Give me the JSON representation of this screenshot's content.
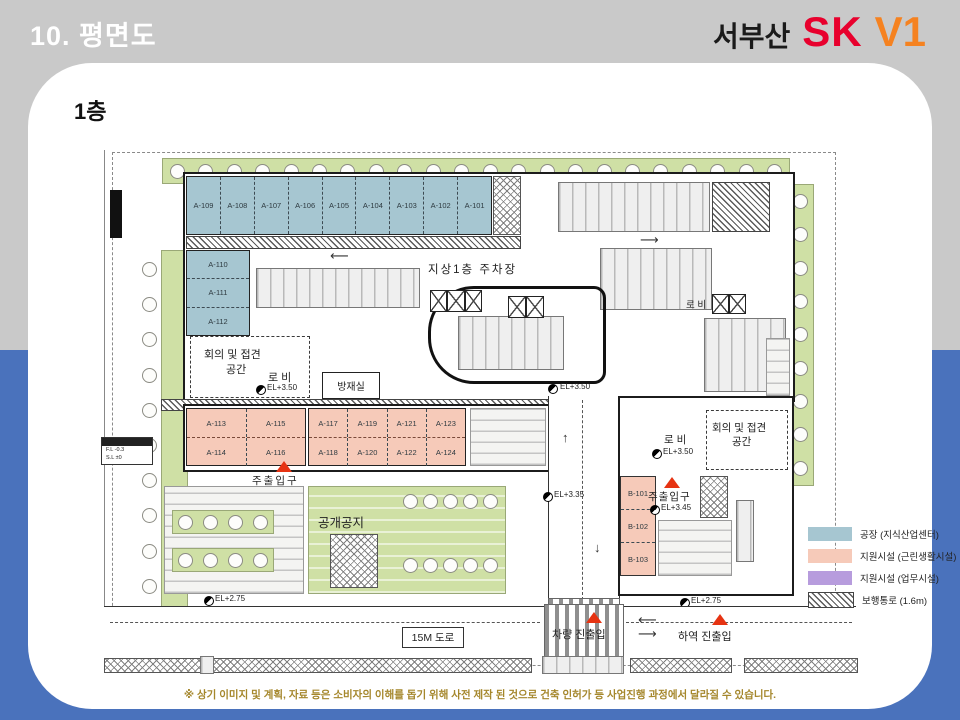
{
  "slide": {
    "title": "10. 평면도",
    "brand": {
      "region": "서부산",
      "sk": "SK",
      "v1": "V1"
    },
    "floor_label": "1층",
    "disclaimer": "※ 상기 이미지 및 계획, 자료 등은 소비자의 이해를 돕기 위해 사전 제작 된 것으로 건축 인허가 등 사업진행 과정에서 달라질 수 있습니다."
  },
  "colors": {
    "header_bg": "#c9c9c9",
    "footer_bg": "#4a72bc",
    "factory": "#a6c6d1",
    "support_retail": "#f6cab9",
    "support_office": "#b79cdd",
    "landscape": "#cfe0a5",
    "entrance_marker": "#e63312"
  },
  "legend": {
    "items": [
      {
        "label": "공장 (지식산업센터)",
        "swatch": "factory"
      },
      {
        "label": "지원시설 (근린생활시설)",
        "swatch": "retail"
      },
      {
        "label": "지원시설 (업무시설)",
        "swatch": "office"
      },
      {
        "label": "보행통로 (1.6m)",
        "swatch": "hatch"
      }
    ]
  },
  "plan": {
    "top_units": [
      "A-109",
      "A-108",
      "A-107",
      "A-106",
      "A-105",
      "A-104",
      "A-103",
      "A-102",
      "A-101"
    ],
    "left_units": [
      "A-110",
      "A-111",
      "A-112"
    ],
    "block_a_top": [
      "A-113",
      "A-115"
    ],
    "block_a_bottom": [
      "A-114",
      "A-116"
    ],
    "block_b_top": [
      "A-117",
      "A-119",
      "A-121",
      "A-123"
    ],
    "block_b_bottom": [
      "A-118",
      "A-120",
      "A-122",
      "A-124"
    ],
    "b_units": [
      "B-101",
      "B-102",
      "B-103"
    ],
    "labels": {
      "parking": "지상1층 주차장",
      "meeting_line1": "회의 및 접견",
      "meeting_line2": "공간",
      "lobby": "로 비",
      "disaster_room": "방재실",
      "public_open_space": "공개공지",
      "main_entrance": "주출입구",
      "road_15m": "15M 도로",
      "vehicle_access": "차량 진출입",
      "loading_access": "하역 진출입",
      "el_350": "EL+3.50",
      "el_345": "EL+3.45",
      "el_335": "EL+3.35",
      "el_325": "EL+3.25",
      "el_275": "EL+2.75",
      "table_fl": "F.L  -0.3",
      "table_sl": "S.L  ±0"
    }
  }
}
